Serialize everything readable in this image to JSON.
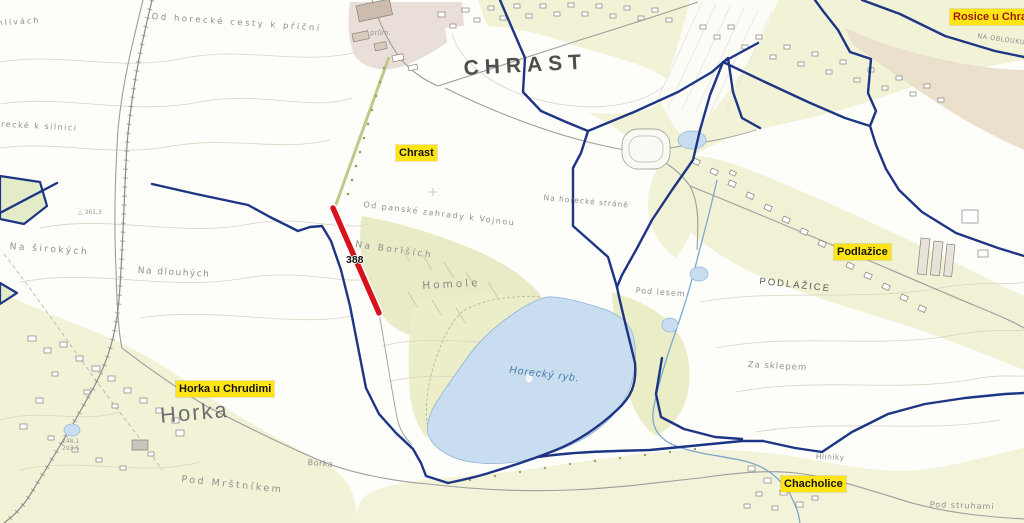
{
  "map": {
    "route_badge": "388",
    "place_markers": [
      {
        "name": "Rosice u Chrasti"
      },
      {
        "name": "Chrast"
      },
      {
        "name": "Podlažice"
      },
      {
        "name": "Horka u Chrudimi"
      },
      {
        "name": "Chacholice"
      }
    ],
    "large_names": {
      "chrast": "CHRAST",
      "horka": "Horka",
      "podlazice": "PODLAŽICE"
    },
    "water_labels": {
      "lake": "Horecký ryb."
    },
    "field_names": [
      "Od horecké cesty k příční",
      "Na hlívách",
      "Od horecké k silnici",
      "Na širokých",
      "Na dlouhých",
      "Na Boriších",
      "Od panské zahrady k Vojnou",
      "Homole",
      "Na horecké stráně",
      "Pod lesem",
      "Za sklepem",
      "Pod Mrštníkem",
      "Borka",
      "Hliníky",
      "NA OBLOUKU",
      "Pod struhami"
    ],
    "small_labels": {
      "factory": "prům.",
      "spot_height": "△ 361,3",
      "elev1": "248,1",
      "elev2": "293,5"
    },
    "colors": {
      "boundary": "#1d3584",
      "highlight_road": "#d8121c",
      "marker_bg": "#ffe515",
      "water": "#c8def0",
      "rosice_text": "#9b1b10"
    }
  }
}
